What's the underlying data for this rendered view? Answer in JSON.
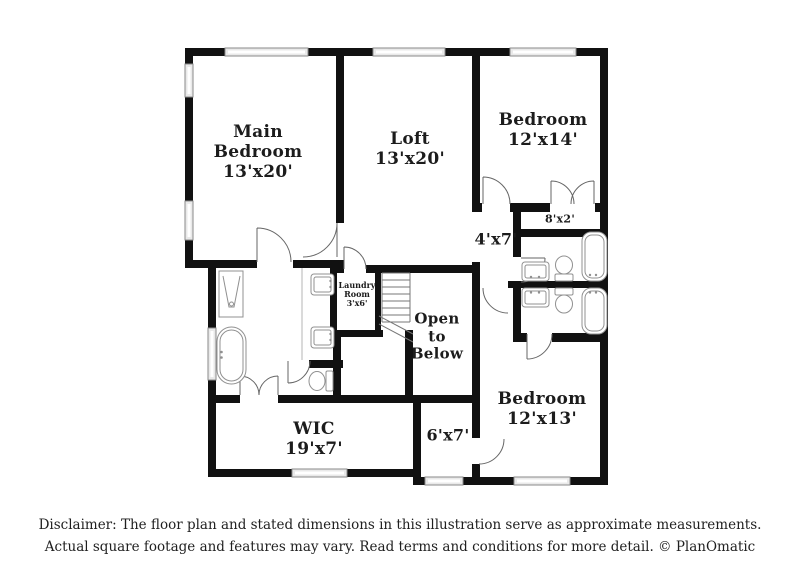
{
  "rooms": {
    "main_bedroom": {
      "name": "Main Bedroom",
      "dims": "13'x20'"
    },
    "loft": {
      "name": "Loft",
      "dims": "13'x20'"
    },
    "bedroom_upper": {
      "name": "Bedroom",
      "dims": "12'x14'"
    },
    "closet_8x2": {
      "dims": "8'x2'"
    },
    "hall_4x7": {
      "dims": "4'x7'"
    },
    "laundry": {
      "name": "Laundry Room",
      "dims": "3'x6'"
    },
    "open_below": {
      "name": "Open to Below"
    },
    "bedroom_lower": {
      "name": "Bedroom",
      "dims": "12'x13'"
    },
    "wic": {
      "name": "WIC",
      "dims": "19'x7'"
    },
    "closet_6x7": {
      "dims": "6'x7'"
    }
  },
  "disclaimer": {
    "line1": "Disclaimer: The floor plan and stated dimensions in this illustration serve as approximate measurements.",
    "line2": "Actual square footage and features may vary. Read terms and conditions for more detail. © PlanOmatic"
  },
  "colors": {
    "wall": "#111111",
    "window_fill": "#e9e9e9",
    "window_border": "#8a8a8a",
    "fixture_stroke": "#909090",
    "door_stroke": "#666666",
    "text": "#1c1c1c",
    "background": "#ffffff"
  }
}
